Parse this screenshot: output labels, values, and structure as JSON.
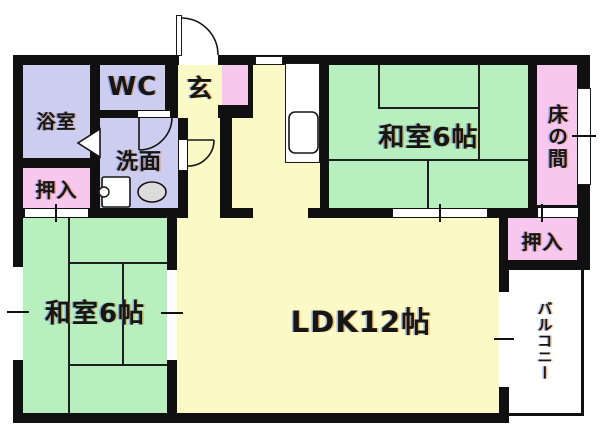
{
  "title": "apartment-floor-plan",
  "colors": {
    "wall": "#101010",
    "lavender": "#cdcdef",
    "pink": "#f8c7ee",
    "green": "#b7efbf",
    "yellow": "#fbf9c6",
    "fixture": "#dcdcdc"
  },
  "rooms": {
    "bath": {
      "label": "浴室"
    },
    "wc": {
      "label": "WC"
    },
    "genkan": {
      "label": "玄"
    },
    "washroom": {
      "label": "洗面"
    },
    "closet_left": {
      "label": "押入"
    },
    "washitsu_left": {
      "label": "和室6帖"
    },
    "washitsu_right": {
      "label": "和室6帖"
    },
    "tokonoma": {
      "label": "床の間"
    },
    "closet_right": {
      "label": "押入"
    },
    "ldk": {
      "label": "LDK12帖"
    },
    "balcony": {
      "label": "バルコニー"
    }
  }
}
